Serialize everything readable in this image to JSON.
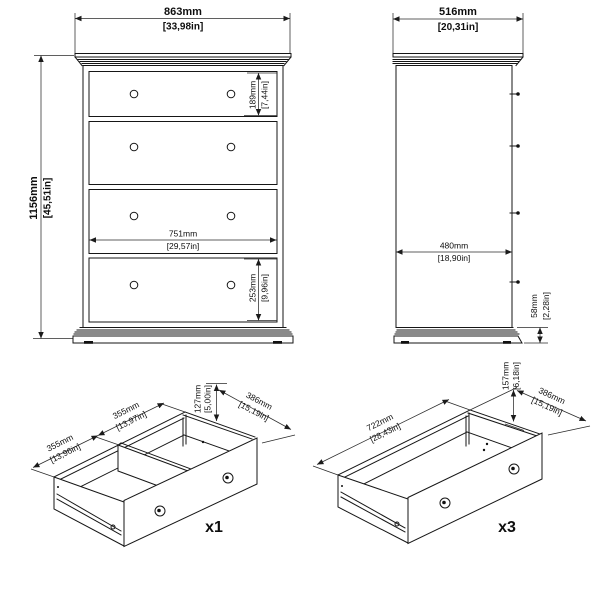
{
  "front_view": {
    "overall_width": {
      "mm": "863mm",
      "inches": "[33,98in]"
    },
    "overall_height": {
      "mm": "1156mm",
      "inches": "[45,51in]"
    },
    "top_drawer_height": {
      "mm": "189mm",
      "inches": "[7,44in]"
    },
    "drawer_inner_width": {
      "mm": "751mm",
      "inches": "[29,57in]"
    },
    "lower_drawer_height": {
      "mm": "253mm",
      "inches": "[9,96in]"
    },
    "drawer_count": 4,
    "knobs_per_drawer": 2
  },
  "side_view": {
    "overall_depth": {
      "mm": "516mm",
      "inches": "[20,31in]"
    },
    "body_depth": {
      "mm": "480mm",
      "inches": "[18,90in]"
    },
    "plinth_height": {
      "mm": "58mm",
      "inches": "[2,28in]"
    }
  },
  "small_drawer_view": {
    "quantity": "x1",
    "compartment_left_width": {
      "mm": "355mm",
      "inches": "[13,96in]"
    },
    "compartment_right_width": {
      "mm": "355mm",
      "inches": "[13,97in]"
    },
    "front_height": {
      "mm": "127mm",
      "inches": "[5,00in]"
    },
    "depth": {
      "mm": "386mm",
      "inches": "[15,19in]"
    }
  },
  "large_drawer_view": {
    "quantity": "x3",
    "inner_width": {
      "mm": "722mm",
      "inches": "[28,43in]"
    },
    "front_height": {
      "mm": "157mm",
      "inches": "[6,18in]"
    },
    "depth": {
      "mm": "386mm",
      "inches": "[15,19in]"
    }
  }
}
